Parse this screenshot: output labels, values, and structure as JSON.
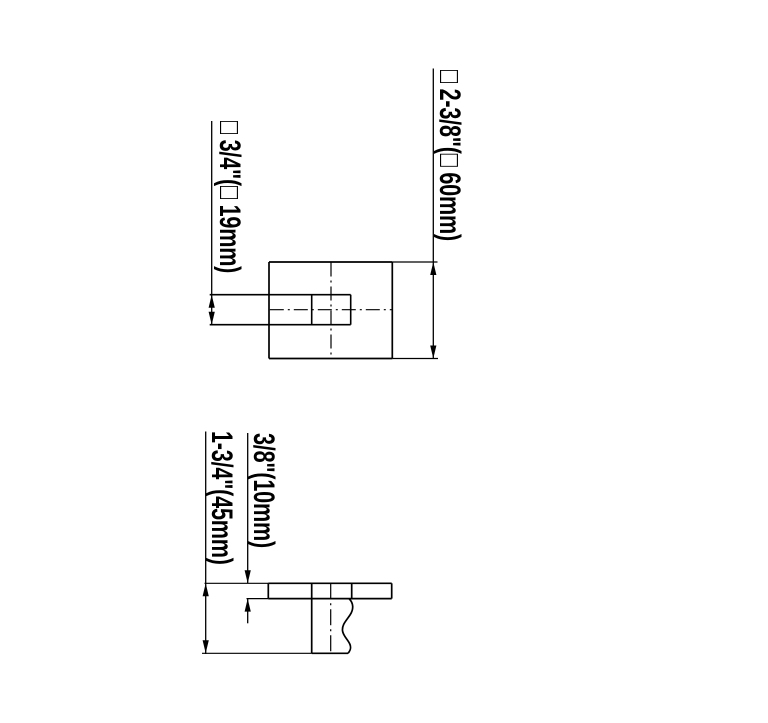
{
  "drawing": {
    "type": "technical-dimension-drawing",
    "background_color": "#ffffff",
    "line_color": "#000000",
    "views": [
      {
        "name": "top-view",
        "dimensions": [
          {
            "id": "arm-width",
            "label": "□ 3/4\"(□ 19mm)"
          },
          {
            "id": "plate-size",
            "label": "□ 2-3/8\"(□ 60mm)"
          }
        ]
      },
      {
        "name": "side-view",
        "dimensions": [
          {
            "id": "plate-thickness",
            "label": "3/8\"(10mm)"
          },
          {
            "id": "overall-depth",
            "label": "1-3/4\"(45mm)"
          }
        ]
      }
    ]
  }
}
